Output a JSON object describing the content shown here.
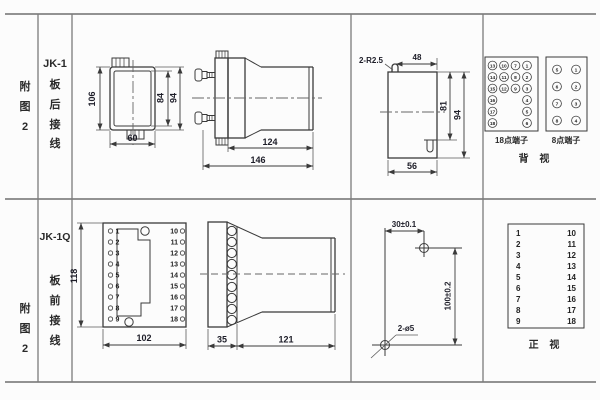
{
  "figure": {
    "row1": {
      "index_label": [
        "附",
        "图",
        "2"
      ],
      "type_label": [
        "JK-1",
        "板",
        "后",
        "接",
        "线"
      ]
    },
    "row2": {
      "index_label": [
        "附",
        "图",
        "2"
      ],
      "type_label": [
        "JK-1Q",
        "板",
        "前",
        "接",
        "线"
      ]
    }
  },
  "dims": {
    "rear_case": {
      "h": "106",
      "inner_h": "84",
      "outer_h": "94",
      "w": "60"
    },
    "rear_side": {
      "body": "124",
      "total": "146"
    },
    "cutout": {
      "slot_note": "2-R2.5",
      "top_w": "48",
      "inner_h": "81",
      "outer_h": "94",
      "bottom_w": "56"
    },
    "front_panel": {
      "h": "118",
      "w": "102"
    },
    "front_side": {
      "plate": "35",
      "body": "121"
    },
    "drill": {
      "x": "30±0.1",
      "y": "100±0.2",
      "holes": "2-ø5"
    }
  },
  "front_panel_terminals": {
    "left": [
      "1",
      "2",
      "3",
      "4",
      "5",
      "6",
      "7",
      "8",
      "9"
    ],
    "right": [
      "10",
      "11",
      "12",
      "13",
      "14",
      "15",
      "16",
      "17",
      "18"
    ]
  },
  "terminal_views": {
    "p18": {
      "label": "18点端子",
      "rows": [
        [
          "13",
          "10",
          "7",
          "1"
        ],
        [
          "14",
          "11",
          "8",
          "2"
        ],
        [
          "15",
          "12",
          "9",
          "3"
        ],
        [
          "16",
          "4"
        ],
        [
          "17",
          "5"
        ],
        [
          "18",
          "6"
        ]
      ]
    },
    "p8": {
      "label": "8点端子",
      "left": [
        "5",
        "6",
        "7",
        "8"
      ],
      "right": [
        "1",
        "2",
        "3",
        "4"
      ]
    },
    "rear_view_label": "背 视",
    "front_view_label": "正 视",
    "front_table": {
      "left": [
        "1",
        "2",
        "3",
        "4",
        "5",
        "6",
        "7",
        "8",
        "9"
      ],
      "right": [
        "10",
        "11",
        "12",
        "13",
        "14",
        "15",
        "16",
        "17",
        "18"
      ]
    }
  }
}
